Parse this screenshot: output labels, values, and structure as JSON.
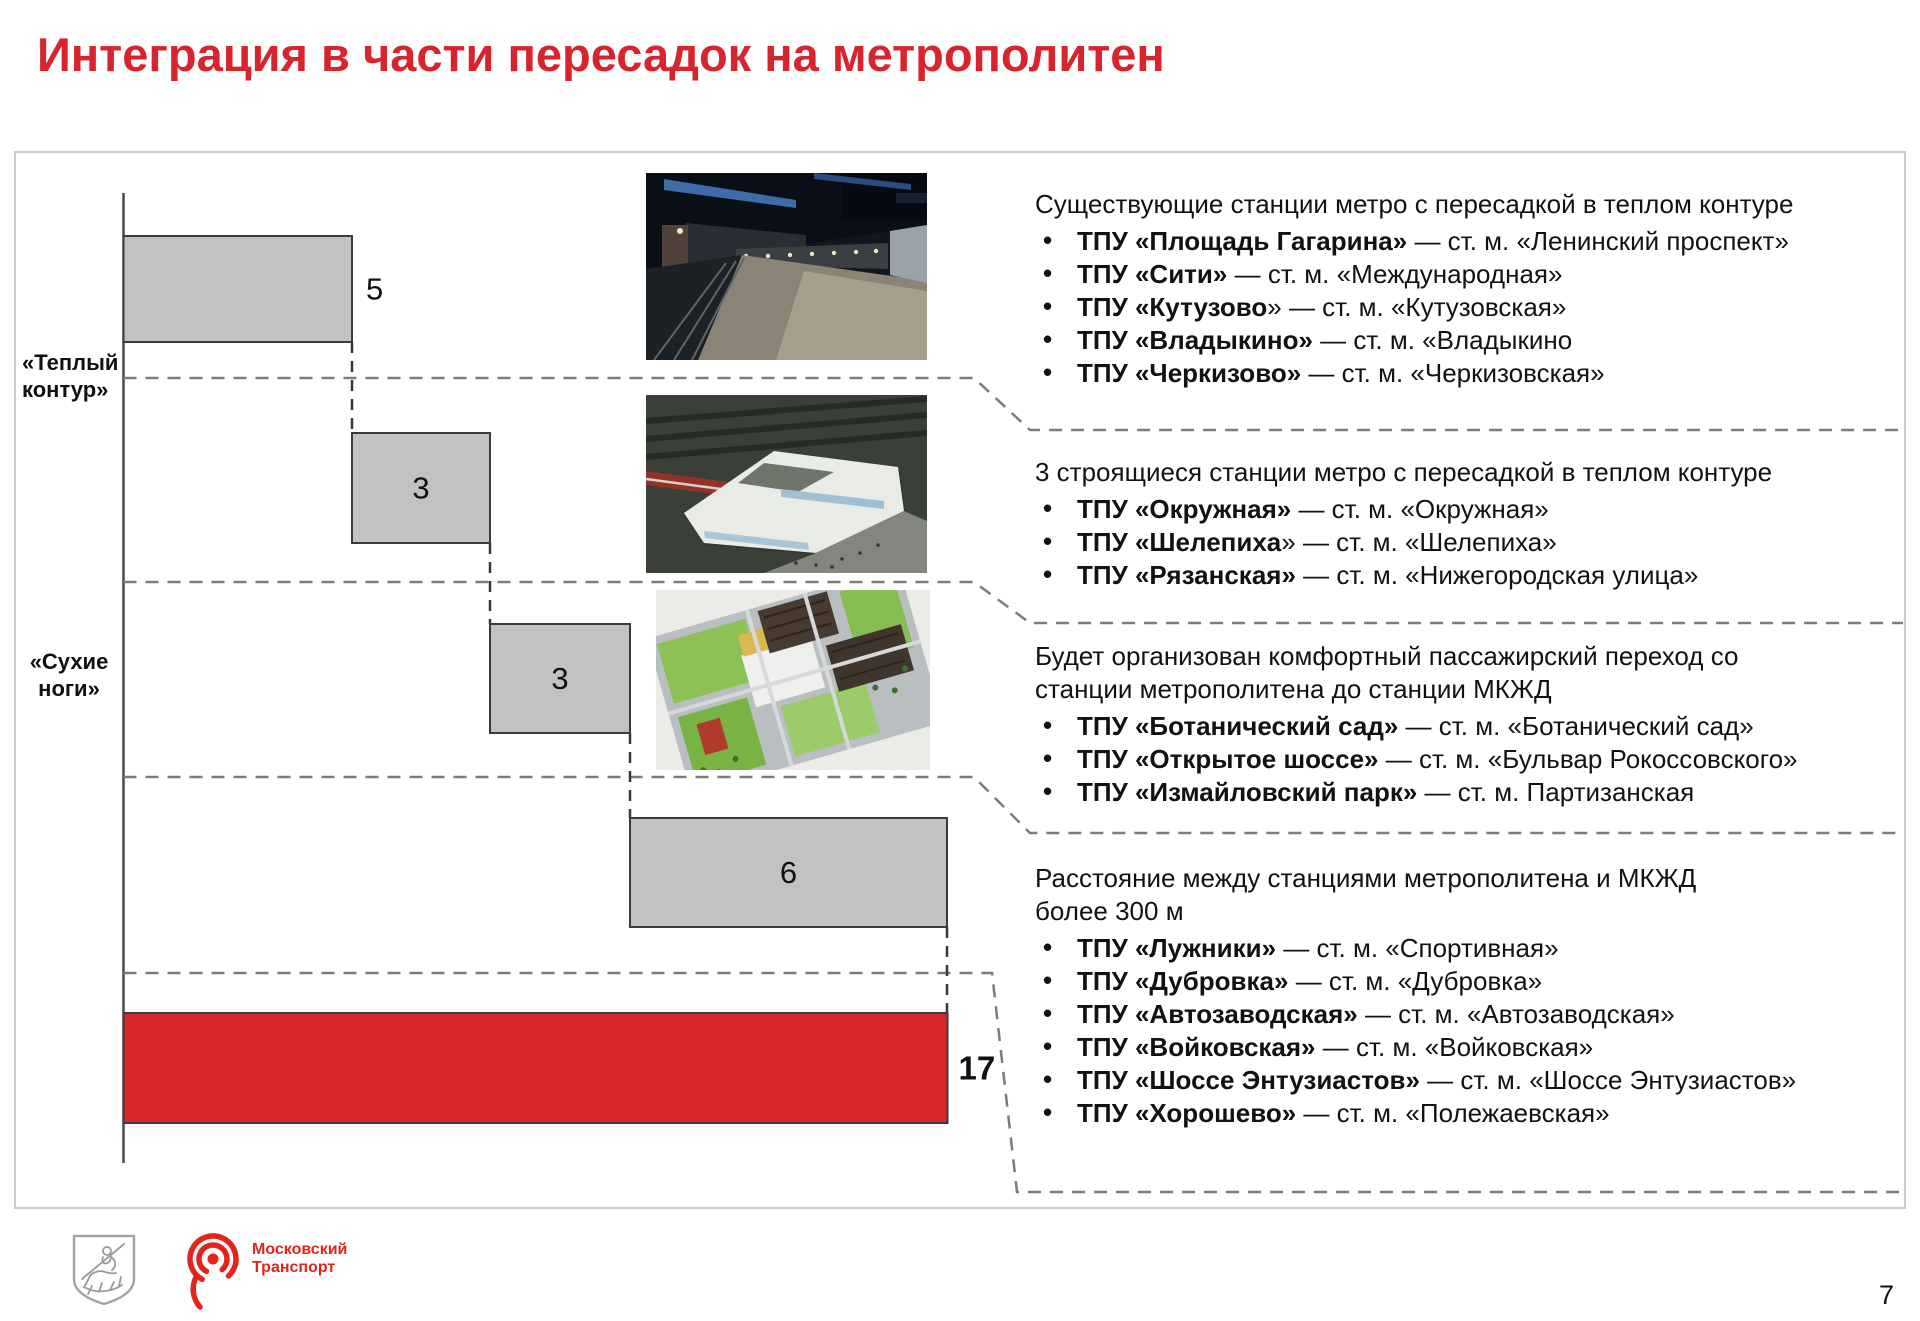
{
  "page": {
    "title": "Интеграция в части пересадок на метрополитен",
    "page_number": "7"
  },
  "colors": {
    "title_red": "#d8242c",
    "bar_red": "#d9262d",
    "bar_gray": "#c2c2c2",
    "bar_border": "#3b3b3b",
    "dash_gray": "#7c7c7c",
    "panel_border": "#cbcbcb",
    "logo_red": "#e2241c"
  },
  "chart_data": {
    "type": "bar",
    "subtype": "horizontal-waterfall-steps",
    "values": [
      5,
      3,
      3,
      6,
      17
    ],
    "series_colors": [
      "gray",
      "gray",
      "gray",
      "gray",
      "red"
    ],
    "categories": [
      "Существующие станции метро с пересадкой в теплом контуре",
      "Строящиеся станции метро с пересадкой в теплом контуре",
      "Комфортный пассажирский переход («сухие ноги»)",
      "Расстояние между станциями более 300 м",
      "Всего"
    ],
    "total": 17,
    "grid": "dashed step levels",
    "legend_position": "none",
    "annotations": {
      "warm_contour": "«Теплый\nконтур»",
      "dry_feet": "«Сухие\nноги»"
    }
  },
  "right_blocks": [
    {
      "heading": "Существующие станции метро с пересадкой в теплом контуре",
      "items": [
        {
          "bold": "ТПУ «Площадь Гагарина»",
          "rest": " — ст. м. «Ленинский проспект»"
        },
        {
          "bold": "ТПУ «Сити»",
          "rest": " — ст. м. «Международная»"
        },
        {
          "bold": "ТПУ «Кутузово",
          "rest": "» — ст. м. «Кутузовская»"
        },
        {
          "bold": "ТПУ «Владыкино»",
          "rest": " — ст. м. «Владыкино"
        },
        {
          "bold": "ТПУ «Черкизово»",
          "rest": " — ст. м. «Черкизовская»"
        }
      ]
    },
    {
      "heading": "3 строящиеся станции метро с пересадкой в теплом контуре",
      "items": [
        {
          "bold": "ТПУ «Окружная»",
          "rest": " — ст. м. «Окружная»"
        },
        {
          "bold": "ТПУ «Шелепиха",
          "rest": "» — ст. м. «Шелепиха»"
        },
        {
          "bold": "ТПУ «Рязанская»",
          "rest": " — ст. м. «Нижегородская улица»"
        }
      ]
    },
    {
      "heading": "Будет организован комфортный пассажирский переход со\nстанции метрополитена до станции МКЖД",
      "items": [
        {
          "bold": "ТПУ «Ботанический сад»",
          "rest": " — ст. м. «Ботанический сад»"
        },
        {
          "bold": "ТПУ «Открытое шоссе»",
          "rest": " — ст. м. «Бульвар Рокоссовского»"
        },
        {
          "bold": "ТПУ «Измайловский парк»",
          "rest": " — ст. м. Партизанская"
        }
      ]
    },
    {
      "heading": "Расстояние между станциями метрополитена и МКЖД\nболее 300 м",
      "items": [
        {
          "bold": "ТПУ «Лужники»",
          "rest": " — ст. м. «Спортивная»"
        },
        {
          "bold": "ТПУ «Дубровка»",
          "rest": " — ст. м. «Дубровка»"
        },
        {
          "bold": "ТПУ «Автозаводская»",
          "rest": " — ст. м. «Автозаводская»"
        },
        {
          "bold": "ТПУ «Войковская»",
          "rest": " — ст. м. «Войковская»"
        },
        {
          "bold": "ТПУ «Шоссе Энтузиастов»",
          "rest": " — ст. м. «Шоссе Энтузиастов»"
        },
        {
          "bold": "ТПУ «Хорошево»",
          "rest": " — ст. м. «Полежаевская»"
        }
      ]
    }
  ],
  "footer": {
    "logo_text": "Московский\nТранспорт"
  }
}
